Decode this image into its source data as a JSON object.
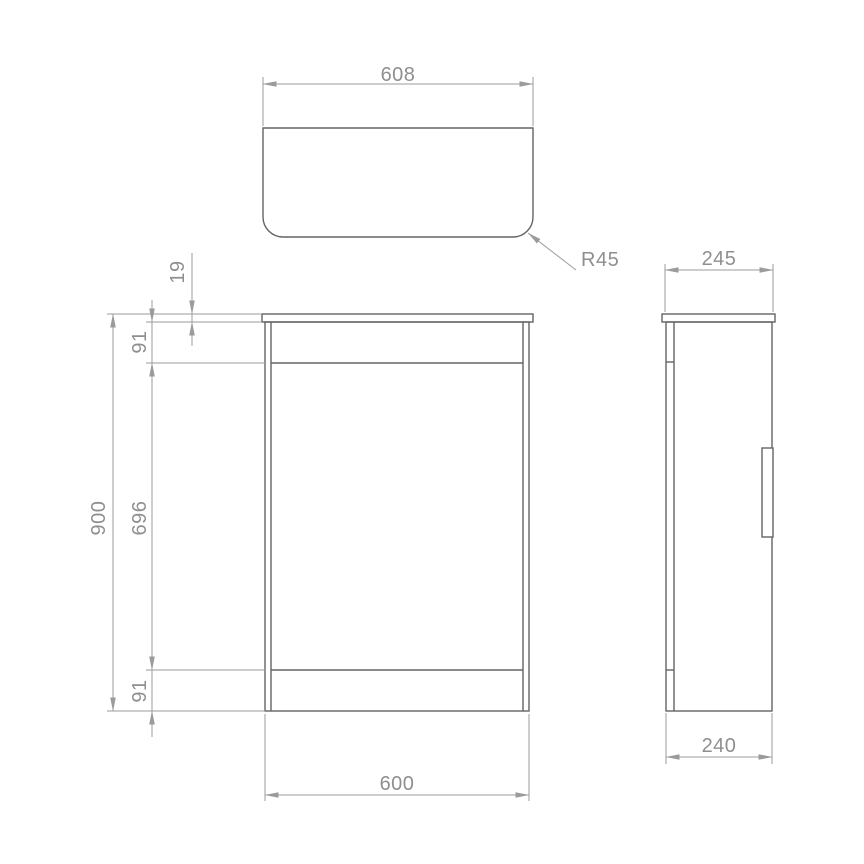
{
  "drawing": {
    "description": "Orthographic technical drawing with three views: countertop plan view, front elevation and side elevation of a floor-standing cabinet unit",
    "views": {
      "top": {
        "width_label": "608",
        "corner_radius_label": "R45"
      },
      "front": {
        "height_label": "900",
        "countertop_thickness_label": "19",
        "top_rail_label": "91",
        "door_height_label": "696",
        "plinth_label": "91",
        "width_label": "600"
      },
      "side": {
        "top_depth_label": "245",
        "bottom_depth_label": "240"
      }
    },
    "colors": {
      "background": "#ffffff",
      "object_line": "#646464",
      "dimension_line": "#9b9b9b",
      "label_text": "#8f8f8f"
    }
  }
}
